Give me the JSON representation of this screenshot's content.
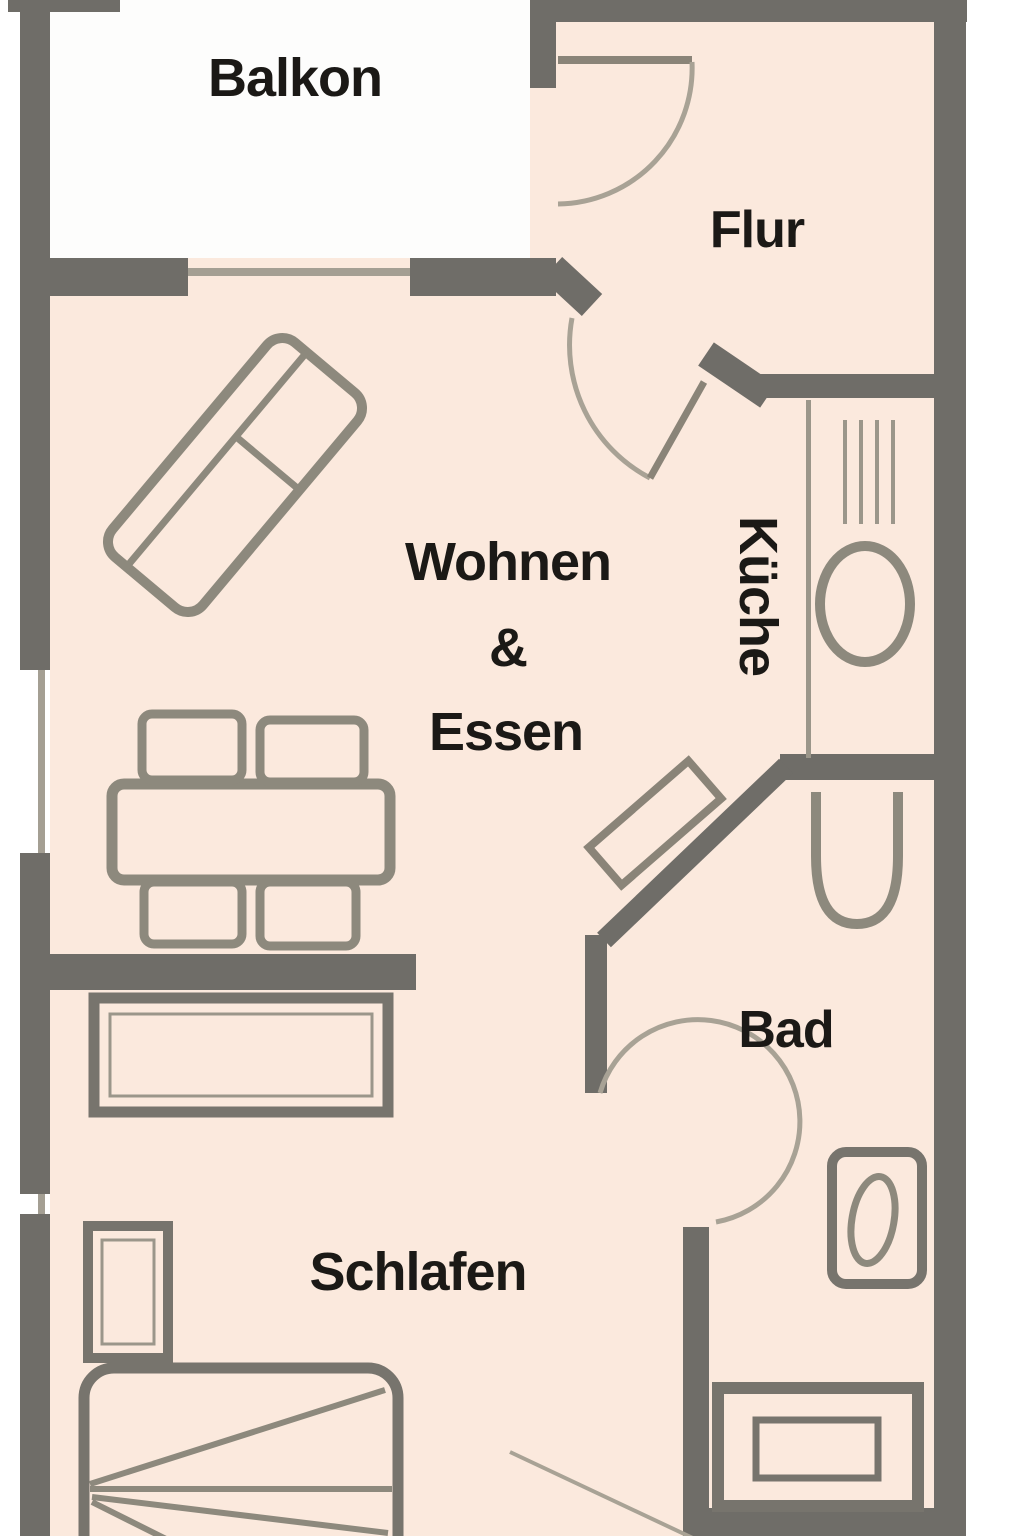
{
  "rooms": {
    "balkon": "Balkon",
    "flur": "Flur",
    "wohnen_essen": {
      "line1": "Wohnen",
      "line2": "&",
      "line3": "Essen"
    },
    "kueche": "Küche",
    "bad": "Bad",
    "schlafen": "Schlafen"
  },
  "colors": {
    "wall": "#6f6d68",
    "room-fill": "#fbe9dd",
    "balcony-fill": "#fdfdfc",
    "window-line": "#a49f93",
    "door-arc": "#a8a295",
    "door-leaf": "#8a8478",
    "furniture": "#8d897d",
    "furniture-dark": "#77746d",
    "thin-line": "#9b968a",
    "label": "#1b1916",
    "background": "#ffffff"
  }
}
